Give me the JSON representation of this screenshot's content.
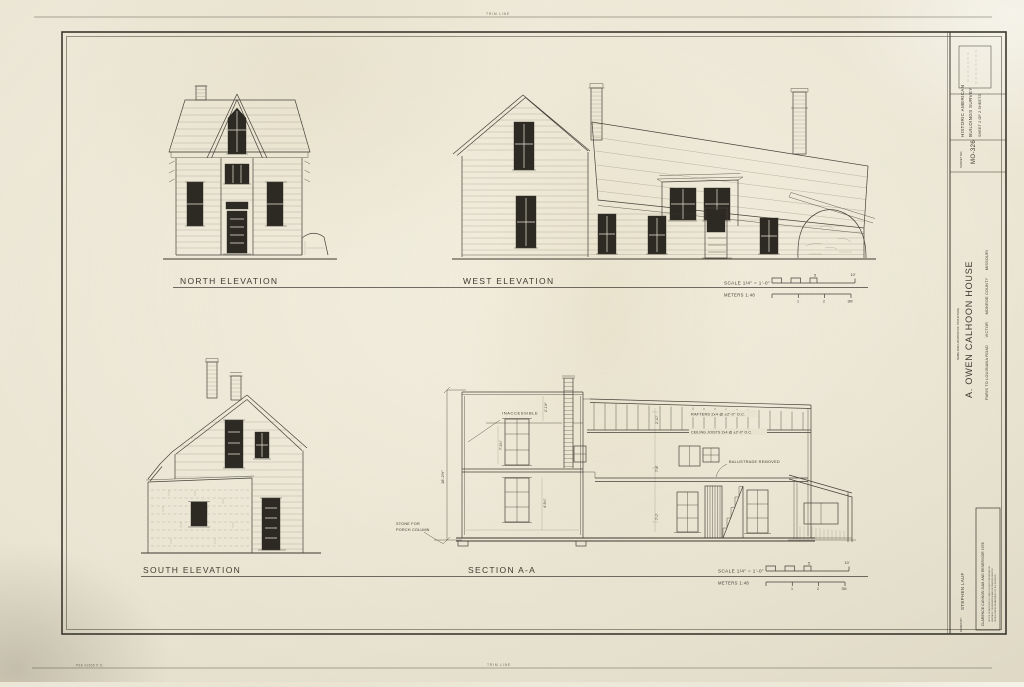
{
  "sheet": {
    "trim_top": "TRIM LINE",
    "trim_bottom": "TRIM LINE",
    "print_code": "P98   41965 P.O."
  },
  "labels": {
    "north": "NORTH ELEVATION",
    "west": "WEST ELEVATION",
    "south": "SOUTH ELEVATION",
    "section": "SECTION A-A"
  },
  "scalebar": {
    "imperial": "SCALE 1/4\" = 1'-0\"",
    "metric": "METERS 1:48",
    "five": "5",
    "ten": "10'",
    "one": "1",
    "two": "2",
    "three": "3M"
  },
  "section_notes": {
    "inaccessible": "INACCESSIBLE",
    "rafters": "RAFTERS 2x4 @ ±2'-0\" O.C.",
    "joists": "CEILING JOISTS 2x4 @ ±2'-0\" O.C.",
    "balustrade": "BALUSTRADE REMOVED",
    "stone1": "STONE FOR",
    "stone2": "PORCH COLUMN",
    "dim_overall": "18'-2½\"",
    "dim_a": "2'-1½\"",
    "dim_b": "7'-3¾\"",
    "dim_c": "4'-9¼\"",
    "dim_d": "2'-10\"",
    "dim_e": "7'-6\"",
    "dim_f": "7'-0\""
  },
  "titleblock": {
    "org1": "HISTORIC AMERICAN",
    "org2": "BUILDINGS SURVEY",
    "sheet_info": "SHEET 2 OF 2 SHEETS",
    "survey_label": "SURVEY NO.",
    "survey_no": "MO-326",
    "name_label": "NAME AND LOCATION OF STRUCTURE",
    "structure_name": "A. OWEN CALHOON HOUSE",
    "structure_location": "PARIS TO LOUISIANA ROAD      VICTOR      MONROE COUNTY      MISSOURI",
    "drawn_label": "DRAWN BY:",
    "drawn_by": "STEPHEN LAUF",
    "project": "CLARENCE CANNON DAM AND RESERVOIR  1978",
    "agency1": "OFFICE OF ARCHEOLOGY AND HISTORIC PRESERVATION",
    "agency2": "HERITAGE CONSERVATION AND RECREATION SERVICE",
    "agency3": "UNITED STATES DEPARTMENT OF THE INTERIOR"
  }
}
